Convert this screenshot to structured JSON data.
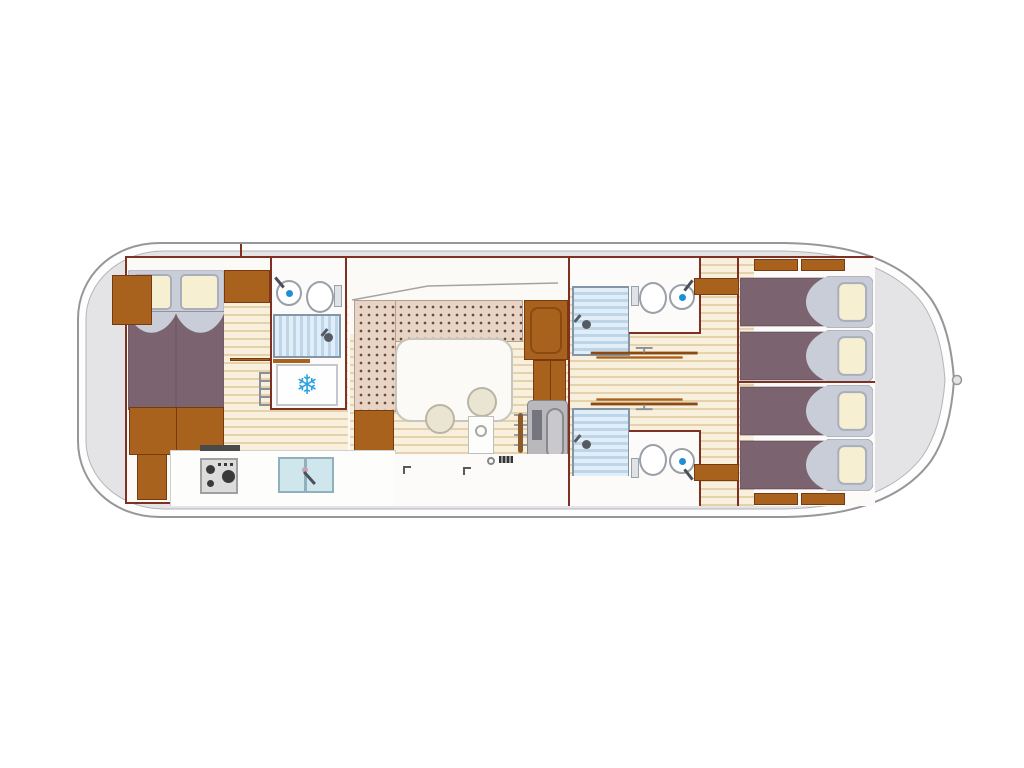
{
  "meta": {
    "type": "boat-floor-plan",
    "view": "top-down interior layout",
    "orientation": "bow-right"
  },
  "icons": {
    "snowflake": "❄"
  },
  "palette": {
    "hull_band": "#fdfdfd",
    "hull_outline": "#97979a",
    "hull_interior": "#e4e4e6",
    "wall": "#7e3122",
    "wood": "#a9611e",
    "wood_dark": "#8a4a12",
    "plank_light": "#f8efdd",
    "plank_line": "#e4d2ac",
    "floor": "#fbfaf7",
    "upholstery": "#e8d4c4",
    "upholstery_dot": "#6d4a3a",
    "bed_blanket": "#7c6370",
    "bed_sheet": "#c9cdd8",
    "pillow": "#f6efd2",
    "shower_light": "#e2eef7",
    "shower_dark": "#bcd5e9",
    "fixture_border": "#9aa0a8",
    "accent_blue": "#2aa2e2",
    "console": "#b9b9bd",
    "table": "#fbfaf6",
    "stool": "#e9e5d2"
  },
  "inventory": {
    "double_beds": 1,
    "single_beds": 4,
    "showers": 3,
    "toilets": 3,
    "washbasins": 3,
    "rooms": [
      {
        "id": "aft-cabin",
        "features": [
          "double-bed",
          "nightstand",
          "wardrobes"
        ]
      },
      {
        "id": "aft-bathroom",
        "features": [
          "washbasin",
          "toilet",
          "shower"
        ]
      },
      {
        "id": "galley",
        "features": [
          "refrigerator",
          "stove",
          "double-sink",
          "counter"
        ]
      },
      {
        "id": "saloon",
        "features": [
          "u-shaped-sofa",
          "table",
          "stool",
          "stool"
        ]
      },
      {
        "id": "helm-station",
        "features": [
          "steering-wheel",
          "console",
          "wardrobe"
        ]
      },
      {
        "id": "mid-bathroom-port",
        "features": [
          "shower",
          "toilet",
          "washbasin"
        ]
      },
      {
        "id": "mid-bathroom-starboard",
        "features": [
          "shower",
          "toilet",
          "washbasin"
        ]
      },
      {
        "id": "corridor",
        "features": [
          "boathook",
          "boathook"
        ]
      },
      {
        "id": "bow-cabin-port",
        "features": [
          "single-bed",
          "single-bed"
        ]
      },
      {
        "id": "bow-cabin-starboard",
        "features": [
          "single-bed",
          "single-bed"
        ]
      }
    ]
  }
}
